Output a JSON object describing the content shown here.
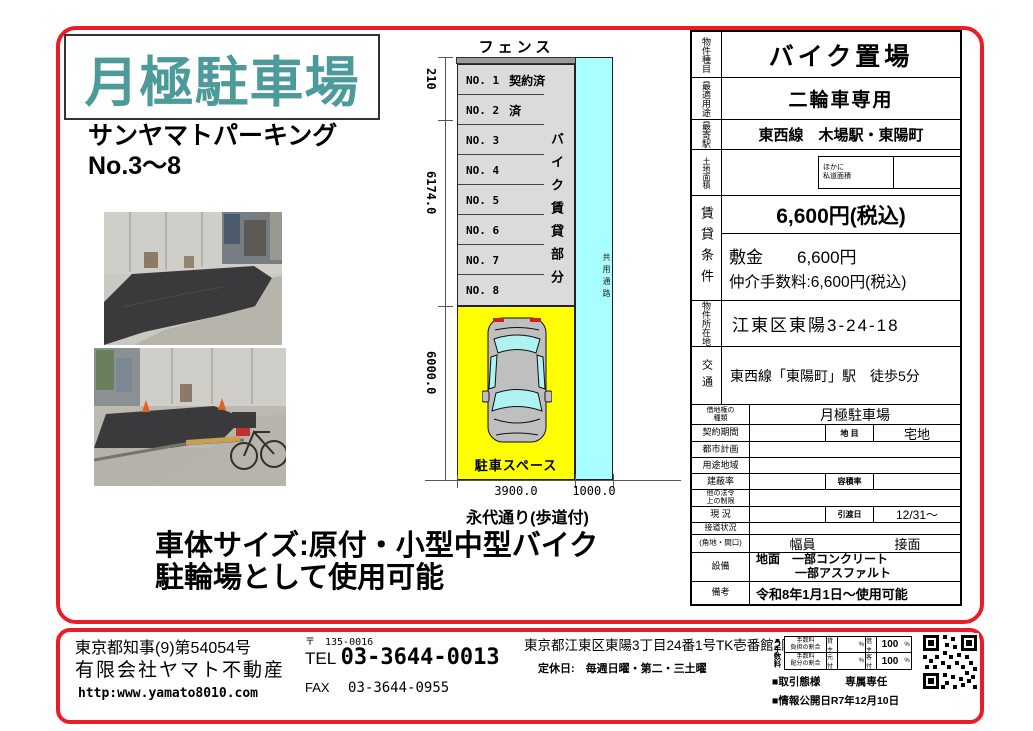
{
  "colors": {
    "accent_red": "#ec1c24",
    "title_teal": "#4d9a9a",
    "lot_yellow": "#ffff00",
    "corridor_cyan": "#a9ffff"
  },
  "header": {
    "title": "月極駐車場",
    "subtitle1": "サンヤマトパーキング",
    "subtitle2": "No.3〜8"
  },
  "notes": {
    "line1": "車体サイズ:原付・小型中型バイク",
    "line2": "駐輪場として使用可能"
  },
  "diagram": {
    "fence_label": "フェンス",
    "spaces": [
      {
        "no": "NO. 1",
        "status": "契約済"
      },
      {
        "no": "NO. 2",
        "status": "済"
      },
      {
        "no": "NO. 3",
        "status": ""
      },
      {
        "no": "NO. 4",
        "status": ""
      },
      {
        "no": "NO. 5",
        "status": ""
      },
      {
        "no": "NO. 6",
        "status": ""
      },
      {
        "no": "NO. 7",
        "status": ""
      },
      {
        "no": "NO. 8",
        "status": ""
      }
    ],
    "rental_label": "バイク賃貸部分",
    "corridor_label": "共用通路",
    "parking_label": "駐車スペース",
    "dims": {
      "top": "210",
      "middle": "6174.0",
      "lower": "6000.0",
      "width_main": "3900.0",
      "width_side": "1000.0"
    },
    "road_label": "永代通り(歩道付)"
  },
  "spec_table": {
    "property_type_label": "物件種目",
    "property_type": "バイク置場",
    "best_use_label": "最適用途",
    "best_use": "二輪車専用",
    "station_label": "最寄駅",
    "station": "東西線　木場駅・東陽町",
    "land_area_label": "土地面積",
    "land_area_note1": "ほかに",
    "land_area_note2": "私道面積",
    "rent_label": "賃貸条件",
    "rent_price": "6,600円(税込)",
    "deposit": "敷金　　6,600円",
    "commission": "仲介手数料:6,600円(税込)",
    "location_label": "物件所在地",
    "location": "江東区東陽3-24-18",
    "access_label": "交通",
    "access": "東西線「東陽町」駅　徒歩5分",
    "lease_type_label1": "借地権の",
    "lease_type_label2": "種類",
    "lease_type": "月極駐車場",
    "contract_label": "契約期間",
    "land_cat_label": "地 目",
    "land_cat": "宅地",
    "city_plan_label": "都市計画",
    "zoning_label": "用途地域",
    "bcr_label": "建蔽率",
    "far_label": "容積率",
    "other_law_label1": "他の法令",
    "other_law_label2": "上の制限",
    "current_label": "現 況",
    "handover_label": "引渡日",
    "handover": "12/31〜",
    "road_contact_label": "接道状況",
    "corner_label": "(角地・間口)",
    "width_header": "幅員",
    "contact_header": "接面",
    "equipment_label": "設備",
    "equipment1": "地面　一部コンクリート",
    "equipment2": "一部アスファルト",
    "remarks_label": "備考",
    "remarks": "令和8年1月1日〜使用可能"
  },
  "footer": {
    "license": "東京都知事(9)第54054号",
    "company": "有限会社ヤマト不動産",
    "url": "http:www.yamato8010.com",
    "postal": "〒　135-0016",
    "tel_label": "TEL",
    "tel": "03-3644-0013",
    "fax_label": "FAX",
    "fax": "03-3644-0955",
    "address": "東京都江東区東陽3丁目24番1号TK壱番館2階",
    "holiday": "定休日:　毎週日曜・第二・三土曜",
    "fee_section_label": "■手数料",
    "fee_rows": [
      {
        "l1": "手数料",
        "l2": "負担の割合",
        "p1": "貸主",
        "pct": "%",
        "p2": "借主",
        "v": "100",
        "pct2": "%"
      },
      {
        "l1": "手数料",
        "l2": "配分の割合",
        "p1": "元付",
        "pct": "%",
        "p2": "客付",
        "v": "100",
        "pct2": "%"
      }
    ],
    "transaction_label": "■取引態様",
    "transaction": "専属専任",
    "published": "■情報公開日R7年12月10日"
  }
}
